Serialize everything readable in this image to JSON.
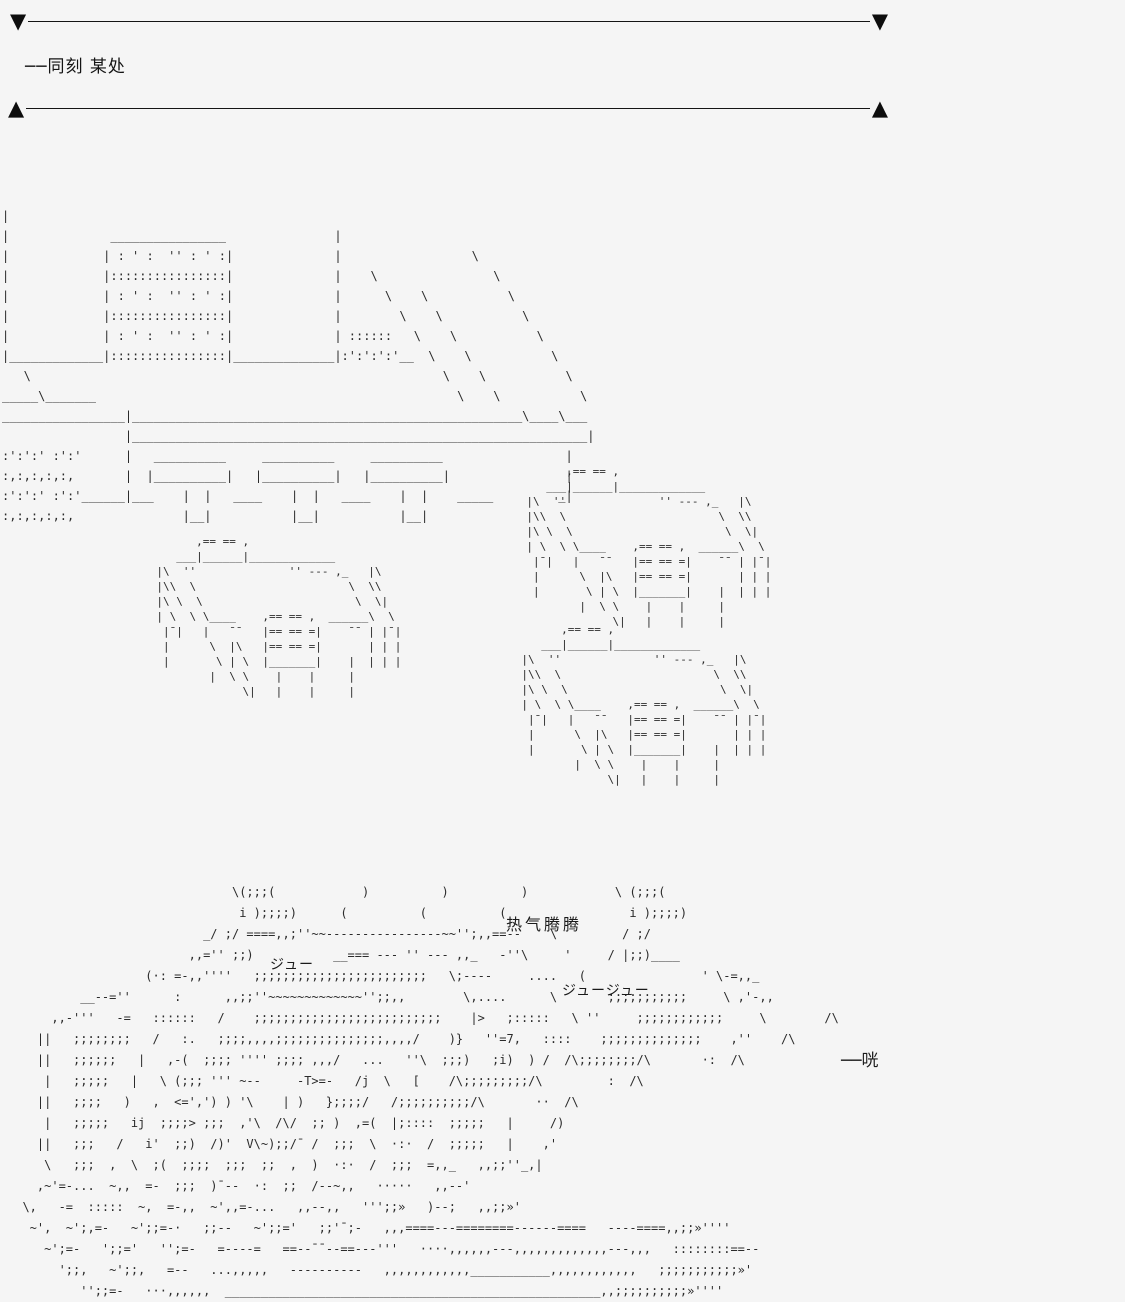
{
  "divider": {
    "down_marker": "▼",
    "up_marker": "▲"
  },
  "caption": "──同刻 某处",
  "labels": {
    "steam": "热气腾腾",
    "sizzle_left": "ジュー",
    "sizzle_right": "ジュージュー",
    "clang_sfx": "──咣"
  },
  "ascii": {
    "building": [
      "|",
      "|              ________________               |",
      "|             | : ' :  '' : ' :|              |                  \\",
      "|             |::::::::::::::::|              |    \\                \\",
      "|             | : ' :  '' : ' :|              |      \\    \\           \\",
      "|             |::::::::::::::::|              |        \\    \\           \\",
      "|             | : ' :  '' : ' :|              | ::::::   \\    \\           \\",
      "|_____________|::::::::::::::::|______________|:':':':'__  \\    \\           \\",
      "   \\                                                         \\    \\           \\",
      "_____\\_______                                                  \\    \\           \\",
      "_________________|______________________________________________________\\____\\___",
      "                 |_______________________________________________________________|",
      ":':':' :':'      |   __________     __________     __________                 |",
      ":,:,:,:,:,       |  |__________|   |__________|   |__________|                |",
      ":':':' :':'______|___    |  |   ____    |  |   ____    |  |    _____         _|",
      ":,:,:,:,:,               |__|           |__|           |__|"
    ],
    "table": [
      "             ,== == ,",
      "          ___|______|_____________",
      "       |\\  ''              '' --- ,_   |\\",
      "       |\\\\  \\                       \\  \\\\",
      "       |\\ \\  \\                       \\  \\|",
      "       | \\  \\ \\____    ,== == ,  ______\\  \\",
      "        |¯|   |   ¯¯   |== == =|    ¯¯ | |¯|",
      "        |      \\  |\\   |== == =|       | | |",
      "        |       \\ | \\  |_______|    |  | | |",
      "               |  \\ \\    |    |     |",
      "                    \\|   |    |     |"
    ],
    "food": [
      "                               \\(;;;(            )          )          )            \\ (;;;(",
      "                                i );;;;)      (          (          (                 i );;;;)",
      "                           _/ ;/ ====,,;''~~----------------~~'';,,==--    \\         / ;/",
      "                         ,,='' ;;)           __=== --- '' --- ,,_   -''\\     '     / |;;)____",
      "                   (·: =-,,''''   ;;;;;;;;;;;;;;;;;;;;;;;;   \\;----     ....   (                ' \\-=,,_",
      "          __--=''      :      ,,;;''~~~~~~~~~~~~~'';;,,        \\,....      \\       ;;;;;;;;;;;     \\ ,'-,,",
      "      ,,-'''   -=   ::::::   /    ;;;;;;;;;;;;;;;;;;;;;;;;;;    |>   ;:::::   \\ ''     ;;;;;;;;;;;;     \\        /\\",
      "    ||   ;;;;;;;;   /   :.   ;;;;,,,,;;;;;;;;;;;;;;;,,,,/    )}   ''=7,   ::::    ;;;;;;;;;;;;;;    ,''    /\\",
      "    ||   ;;;;;;   |   ,-(  ;;;; '''' ;;;; ,,,/   ...   ''\\  ;;;)   ;i)  ) /  /\\;;;;;;;;/\\       ·:  /\\",
      "     |   ;;;;;   |   \\ (;;; ''' ~--     -T>=-   /j  \\   [    /\\;;;;;;;;;/\\         :  /\\",
      "    ||   ;;;;   )   ,  <=',') ) '\\    | )   };;;;/   /;;;;;;;;;;/\\       ··  /\\",
      "     |   ;;;;;   ij  ;;;;> ;;;  ,'\\  /\\/  ;; )  ,=(  |;::::  ;;;;;   |     /)",
      "    ||   ;;;   /   i'  ;;)  /)'  V\\~);;/¯ /  ;;;  \\  ·:·  /  ;;;;;   |    ,'",
      "     \\   ;;;  ,  \\  ;(  ;;;;  ;;;  ;;  ,  )  ·:·  /  ;;;  =,,_   ,,;;''_,|",
      "    ,~'=-...  ~,,  =-  ;;;  )¯--  ·:  ;;  /--~,,   ·····   ,,--'",
      "  \\,   -=  :::::  ~,  =-,,  ~',,=-...   ,,--,,   ''';;»   )--;   ,,;;»'",
      "   ~',  ~';,=-   ~';;=-·   ;;--   ~';;='   ;;'¯;-   ,,,====---========------====   ----====,,;;»''''",
      "     ~';=-   ';;='   '';=-   =----=   ==--¯¯--==---'''   ····,,,,,,---,,,,,,,,,,,,,---,,,   ::::::::==--",
      "       ';;,   ~';;,   =--   ...,,,,,   ----------   ,,,,,,,,,,,,___________,,,,,,,,,,,,   ;;;;;;;;;;;»'",
      "          '';;=-   ···,,,,,,  ____________________________________________________,,;;;;;;;;;;»''''"
    ]
  }
}
